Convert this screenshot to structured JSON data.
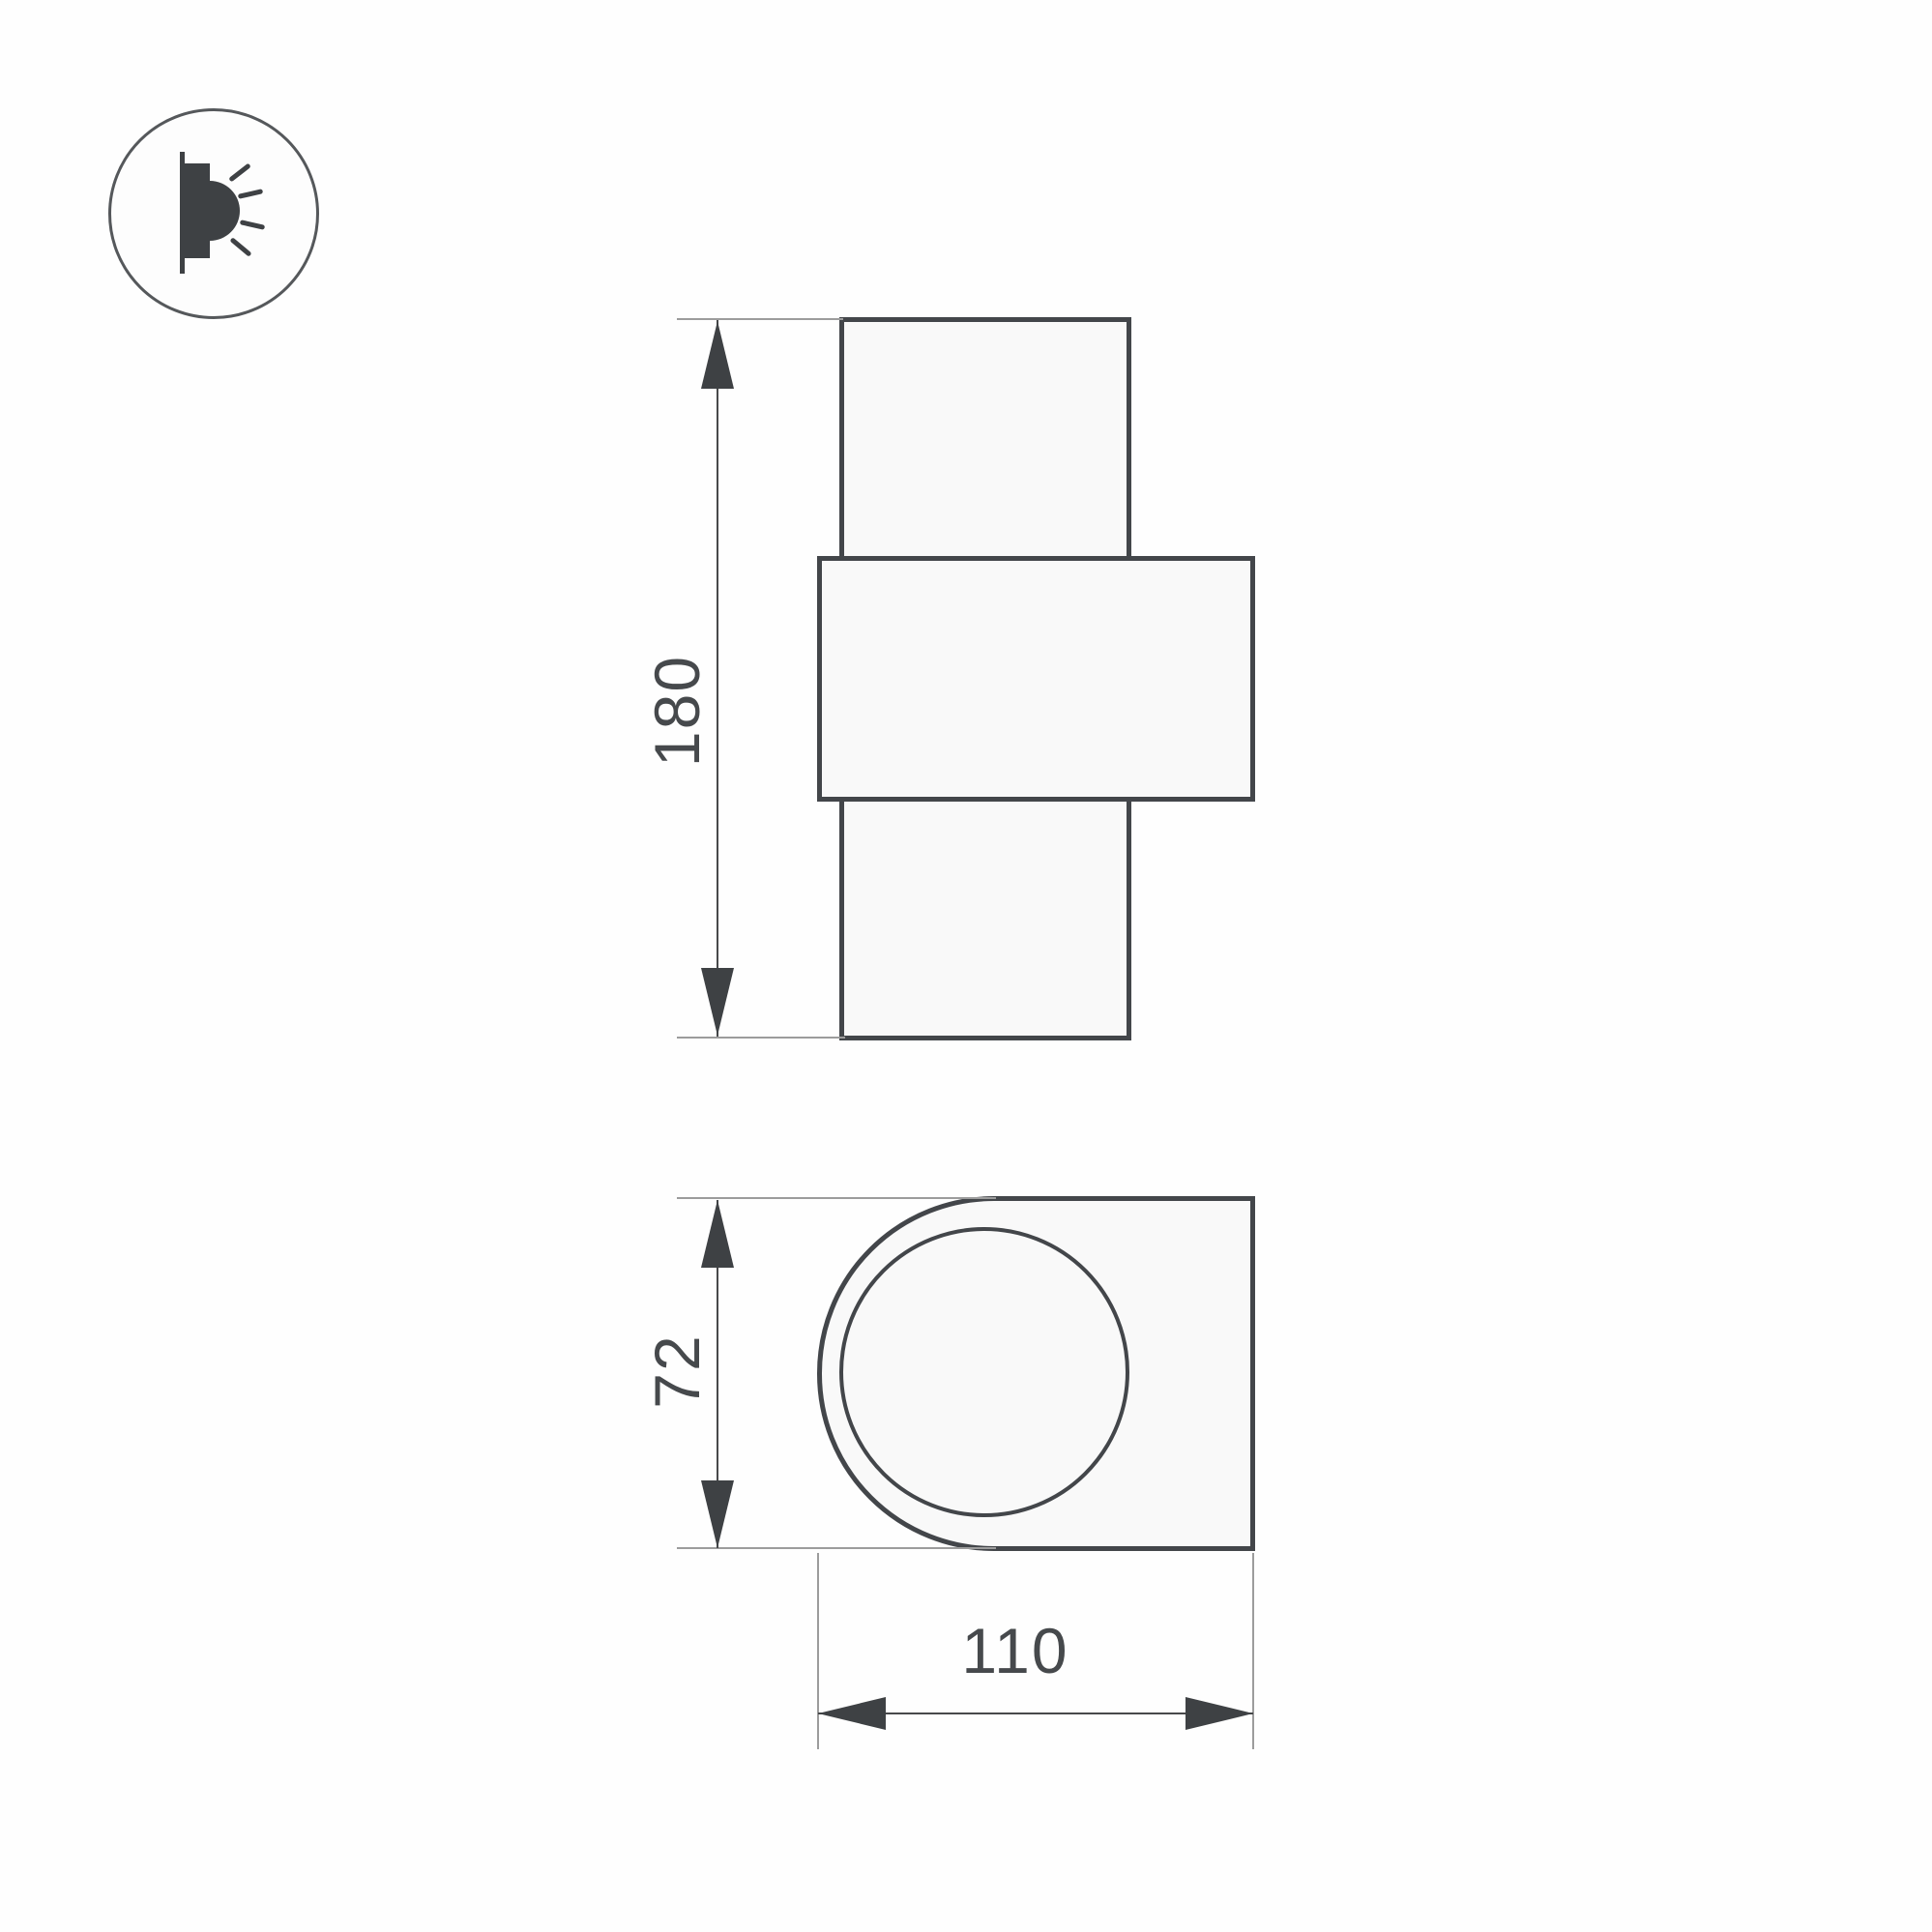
{
  "title": "wall-luminaire-dimension-drawing",
  "icon": {
    "name": "wall-mounted-light-emission-icon"
  },
  "front_view": {
    "height_label": "180"
  },
  "side_view": {
    "height_label": "72",
    "depth_label": "110"
  },
  "colors": {
    "outline": "#43464a",
    "dimension_line": "#48494b",
    "extension_line": "#9c9c9c",
    "arrow_fill": "#3e4144",
    "text": "#46494c",
    "shape_fill": "#f9f9f9",
    "background": "#fefefe"
  }
}
